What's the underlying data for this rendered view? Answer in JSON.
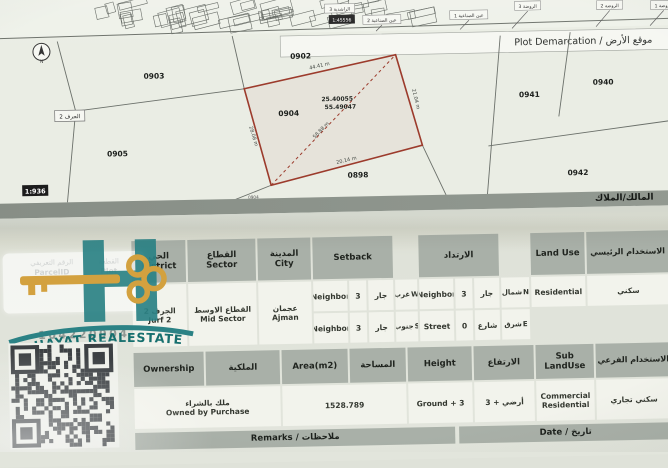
{
  "colors": {
    "plot_outline_red": "#9c3b2c",
    "brand_teal": "#2b8285",
    "key_gold": "#d3a13f",
    "table_header_gray": "#a9b0a8"
  },
  "overview_map": {
    "scale_chip": "1:45556",
    "area_labels": [
      "الراشدية 3",
      "عين الصناعية 2",
      "عين الصناعية 1",
      "الروضة 3",
      "الروضة 2",
      "الروضة 1"
    ]
  },
  "demarcation": {
    "title": "Plot Demarcation / موقع الأرض",
    "scale_chip": "1:936",
    "district_chip": "الجرف 2",
    "owner_band_label": "المالك/الملاك",
    "north_label": "N",
    "plot_numbers": {
      "p0903": "0903",
      "p0902": "0902",
      "p0904": "0904",
      "p0905": "0905",
      "p0898": "0898",
      "p0941": "0941",
      "p0940": "0940",
      "p0942": "0942",
      "p0904_small": "0904"
    },
    "target_plot": {
      "number": "0904",
      "latitude": "25.40055",
      "longitude": "55.49047",
      "edge_lengths": {
        "top": "44.41 m",
        "right": "21.04 m",
        "bottom": "20.14 m",
        "left": "28.08 m",
        "diagonal": "58.88 m"
      }
    }
  },
  "table": {
    "headers": {
      "district_ar": "الحي",
      "district_en": "District",
      "sector_ar": "القطاع",
      "sector_en": "Sector",
      "city_ar": "المدينة",
      "city_en": "City",
      "setback_en": "Setback",
      "setback_ar": "الارتداد",
      "land_use": "Land Use",
      "main_use_ar": "الاستخدام الرئيسي",
      "ownership_en": "Ownership",
      "ownership_ar": "الملكية",
      "area_en": "Area(m2)",
      "area_ar": "المساحة",
      "height_en": "Height",
      "height_ar": "الارتفاع",
      "sub_land_use_en": "Sub LandUse",
      "sub_use_ar": "الاستخدام الفرعي",
      "remarks": "Remarks / ملاحظات",
      "date": "Date / تاريخ"
    },
    "values": {
      "district_ar": "الجرف 2",
      "district_en": "Jurf 2",
      "sector_ar": "القطاع الاوسط",
      "sector_en": "Mid Sector",
      "city_ar": "عجمان",
      "city_en": "Ajman",
      "setbacks": [
        {
          "type_en": "Neighbor",
          "value": "3",
          "type_ar": "جار",
          "dir_ar": "غرب",
          "dir_en": "W"
        },
        {
          "type_en": "Neighbor",
          "value": "3",
          "type_ar": "جار",
          "dir_ar": "جنوب",
          "dir_en": "S"
        },
        {
          "type_en": "Neighbor",
          "value": "3",
          "type_ar": "جار",
          "dir_ar": "شمال",
          "dir_en": "N"
        },
        {
          "type_en": "Street",
          "value": "0",
          "type_ar": "شارع",
          "dir_ar": "شرق",
          "dir_en": "E"
        }
      ],
      "land_use": "Residential",
      "main_use_ar": "سكني",
      "ownership_ar": "ملك بالشراء",
      "ownership_en": "Owned by Purchase",
      "area": "1528.789",
      "height_en": "Ground + 3",
      "height_ar": "أرضي + 3",
      "sub_land_use_en": "Commercial Residential",
      "sub_use_ar": "سكني تجاري"
    }
  },
  "watermark": {
    "brand": "AL HAYAT REALESTATE",
    "parcel_id_number": "104220904",
    "parcel_id_label_ar": "الرقم التعريفي",
    "parcel_id_label_en": "ParcelID",
    "plot_label_ar": "القطعة",
    "plot_label_en": "Plot"
  }
}
